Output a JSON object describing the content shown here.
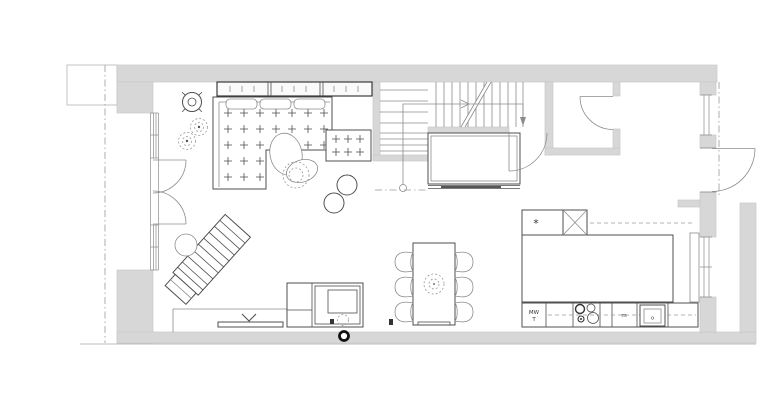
{
  "meta": {
    "title": "Ground floor plan",
    "drawing_type": "architectural floor plan"
  },
  "colors": {
    "wall": "#d7d7d7",
    "wallEdge": "#c8c8c8",
    "line": "#4f4f4f",
    "lineLight": "#8c8c8c",
    "dash": "#9a9a9a",
    "dark": "#2b2b2b",
    "text": "#333333",
    "edge": "#bdbdbd",
    "paper": "#ffffff"
  },
  "labels": {
    "fridge_star": "*",
    "microwave": "MW",
    "tower_t": "T",
    "m_unit": "m",
    "sink_unit": "o"
  },
  "symbols": [
    "exterior-wall",
    "porch-slab",
    "section-line",
    "window",
    "french-doors",
    "entry-door",
    "wc-door",
    "hall-door",
    "staircase",
    "walk-line",
    "understair-closet",
    "sideboard",
    "corner-sofa",
    "ottoman",
    "pouf",
    "beanbag",
    "pendant-light",
    "plant-pot",
    "shrub",
    "lounger",
    "side-table",
    "tv-bench",
    "wood-stove",
    "flue",
    "floor-outlet",
    "dining-table",
    "dining-chair",
    "kitchen-tall-units",
    "kitchen-island",
    "kitchen-base-cabinets",
    "hob",
    "kitchen-sink",
    "radiator-panel",
    "roof-overhang-dashline"
  ]
}
